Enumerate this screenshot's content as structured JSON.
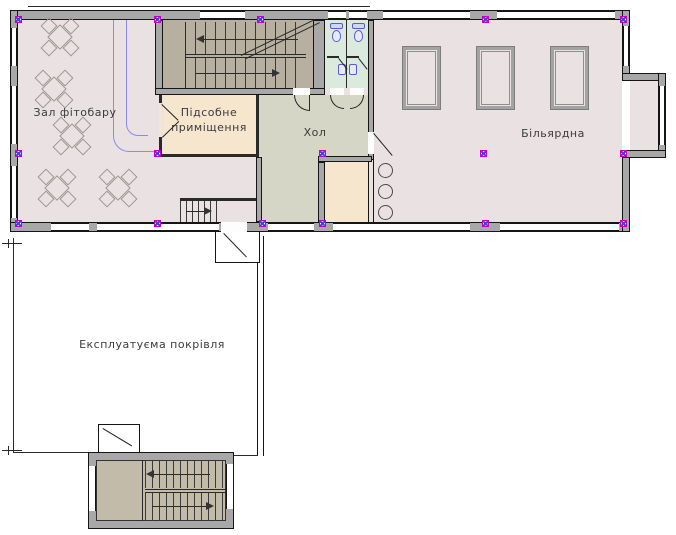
{
  "labels": {
    "fitobar": "Зал фітобару",
    "utility_line1": "Підсобне",
    "utility_line2": "приміщення",
    "hall": "Хол",
    "billiard": "Більярдна",
    "roof": "Експлуатуєма покрівля"
  },
  "colors": {
    "wall_gray": "#a8a8a8",
    "main_floor_pink": "#eae2e2",
    "stair_floor_tan": "#b7af9f",
    "utility_floor_peach": "#f7e6ce",
    "hall_floor_green": "#d6d6c6",
    "wc_floor_mint": "#daeadd",
    "fixture_outline_gray": "#a3a3a3",
    "sanitary_blue": "#5a5ad8",
    "pipe_blue": "#8a8af0",
    "column_marker_magenta": "#c400c4",
    "column_marker_blue": "#4444cc"
  },
  "fixtures": {
    "cafe_tables": 5,
    "billiard_tables": 3,
    "round_tables": 3,
    "toilets": 2,
    "wash_basins": 2,
    "staircases": 3
  }
}
